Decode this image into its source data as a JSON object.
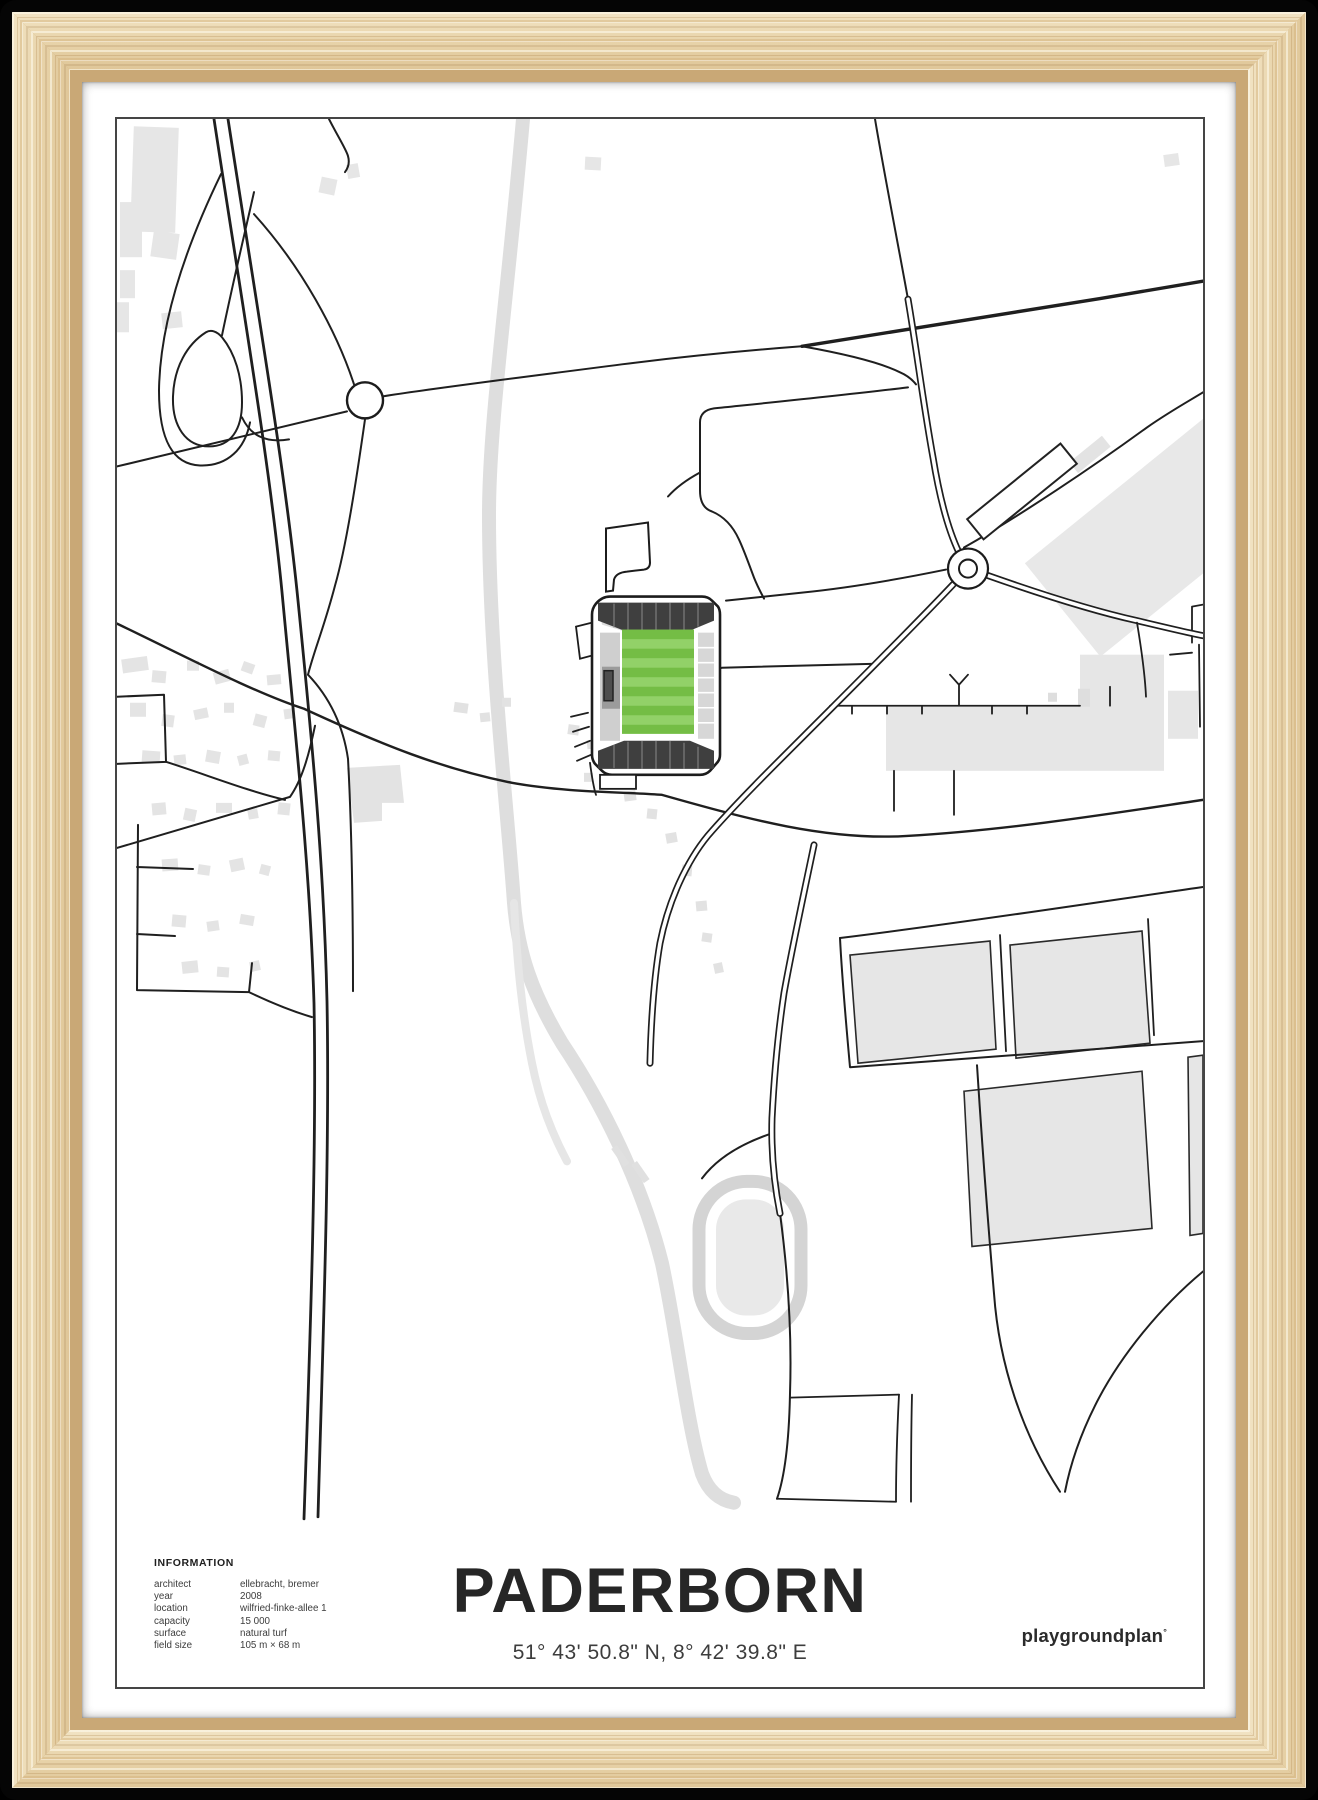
{
  "poster": {
    "title": "PADERBORN",
    "coordinates": "51° 43' 50.8\" N, 8° 42' 39.8\" E",
    "brand": {
      "name": "playgroundplan",
      "mark": "°"
    },
    "information": {
      "heading": "INFORMATION",
      "rows": [
        {
          "label": "architect",
          "value": "ellebracht, bremer"
        },
        {
          "label": "year",
          "value": "2008"
        },
        {
          "label": "location",
          "value": "wilfried-finke-allee 1"
        },
        {
          "label": "capacity",
          "value": "15 000"
        },
        {
          "label": "surface",
          "value": "natural turf"
        },
        {
          "label": "field size",
          "value": "105 m × 68 m"
        }
      ]
    },
    "colors": {
      "pitch_green": "#74bd45",
      "pitch_green_light": "#92d168",
      "road_black": "#1f1f1f",
      "building_gray": "#e6e6e6",
      "stream_gray": "#dedede",
      "stand_dark": "#3f3f3f",
      "frame_wood": "#e8d3ac"
    }
  }
}
